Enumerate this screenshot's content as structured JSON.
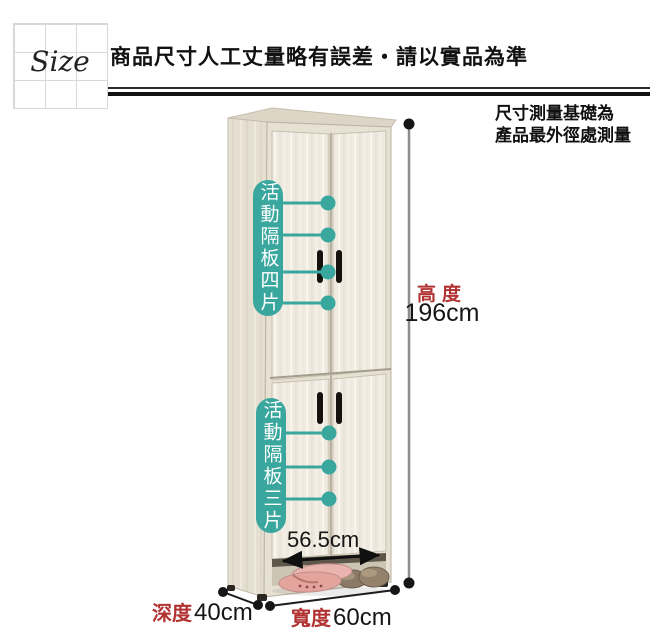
{
  "header": {
    "size_label": "Size",
    "title": "商品尺寸人工丈量略有誤差‧請以實品為準"
  },
  "note": {
    "line1": "尺寸測量基礎為",
    "line2": "產品最外徑處測量"
  },
  "cabinet": {
    "top_section_label": "活動隔板四片",
    "bottom_section_label": "活動隔板三片"
  },
  "dimensions": {
    "height_label": "高度",
    "height_value": "196cm",
    "inner_width_value": "56.5cm",
    "depth_label": "深度",
    "depth_value": "40cm",
    "width_label": "寬度",
    "width_value": "60cm"
  },
  "colors": {
    "accent-teal": "#3aa79e",
    "dim-red": "#b23232"
  }
}
